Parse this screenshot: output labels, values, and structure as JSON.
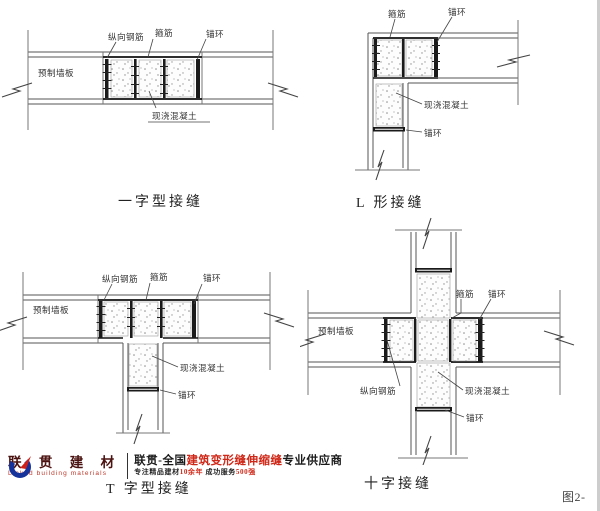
{
  "figure_label": "图2-",
  "diagrams": {
    "straight": {
      "caption": "一字型接缝",
      "labels": {
        "longitudinal_rebar": "纵向钢筋",
        "stirrup": "箍筋",
        "anchor_ring": "锚环",
        "precast_panel": "预制墙板",
        "cast_in_place": "现浇混凝土"
      }
    },
    "l_shape": {
      "caption": "L 形接缝",
      "labels": {
        "stirrup": "箍筋",
        "anchor_ring_top": "锚环",
        "cast_in_place": "现浇混凝土",
        "anchor_ring_bottom": "锚环"
      }
    },
    "t_shape": {
      "caption": "T 字型接缝",
      "labels": {
        "longitudinal_rebar": "纵向钢筋",
        "stirrup": "箍筋",
        "anchor_ring_top": "锚环",
        "precast_panel": "预制墙板",
        "cast_in_place": "现浇混凝土",
        "anchor_ring_bottom": "锚环"
      }
    },
    "cross": {
      "caption": "十字接缝",
      "labels": {
        "stirrup": "箍筋",
        "anchor_ring_top": "锚环",
        "precast_panel": "预制墙板",
        "longitudinal_rebar": "纵向钢筋",
        "cast_in_place": "现浇混凝土",
        "anchor_ring_bottom": "锚环"
      }
    }
  },
  "logo": {
    "company_cn": "联 贯 建 材",
    "company_en": "Linked building materials",
    "tagline": {
      "p1": "联贯-全国",
      "p2": "建筑变形缝伸缩缝",
      "p3": "专业供应商"
    },
    "subline": {
      "p1": "专注精品建材",
      "p2": "10余年",
      "p3": " 成功服务",
      "p4": "500强"
    },
    "brand_blue": "#16339c",
    "brand_red": "#cf2118"
  }
}
